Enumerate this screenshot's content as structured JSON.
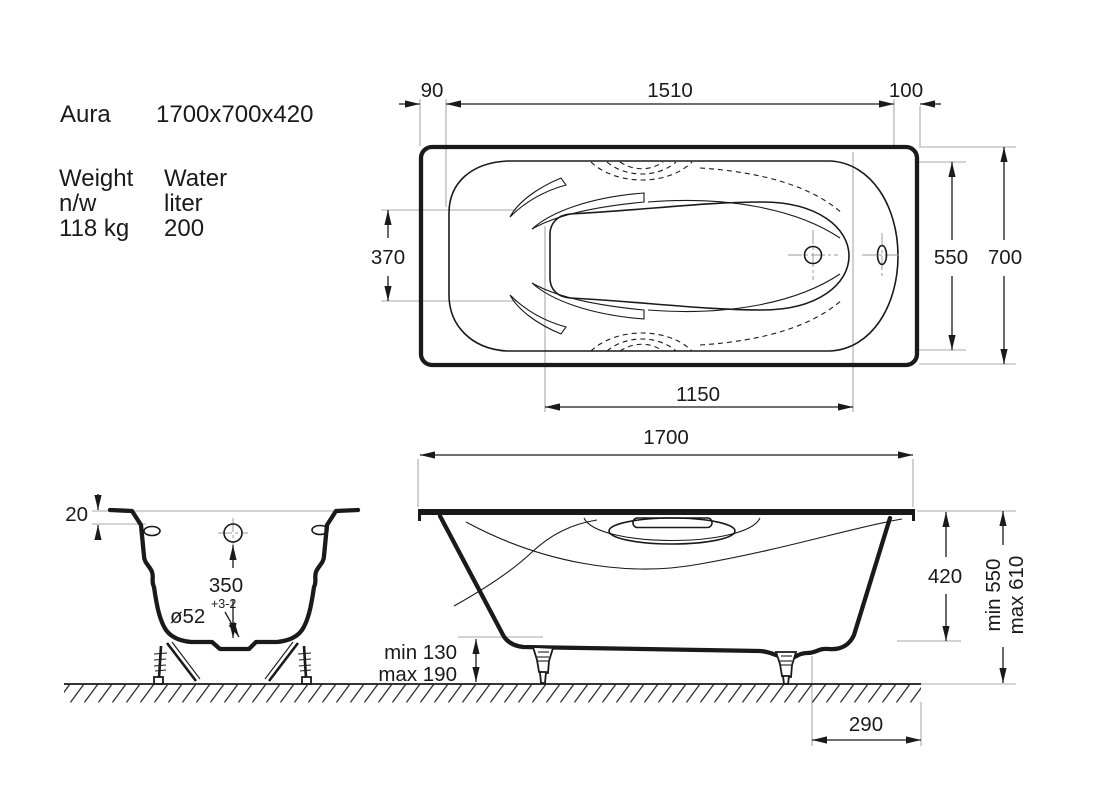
{
  "info": {
    "name": "Aura",
    "dimensions": "1700x700x420",
    "weight_label": "Weight",
    "weight_unit_label": "n/w",
    "weight_value": "118 kg",
    "water_label": "Water",
    "water_unit_label": "liter",
    "water_value": "200"
  },
  "top_view": {
    "offset_left": "90",
    "rim_length": "1510",
    "offset_right": "100",
    "seat_width": "370",
    "inner_width": "550",
    "overall_width": "700",
    "well_length": "1150"
  },
  "side_view": {
    "overall_length": "1700",
    "shell_height": "420",
    "height_min": "min 550",
    "height_max": "max 610",
    "leg_min": "min 130",
    "leg_max": "max 190",
    "drain_offset": "290"
  },
  "end_view": {
    "rim_thickness": "20",
    "overflow_height": "350",
    "drain_diameter": "ø52",
    "drain_tolerance": "+3-2"
  },
  "colors": {
    "line": "#1a1a1a",
    "extension": "#a8a8a8",
    "background": "#ffffff"
  }
}
